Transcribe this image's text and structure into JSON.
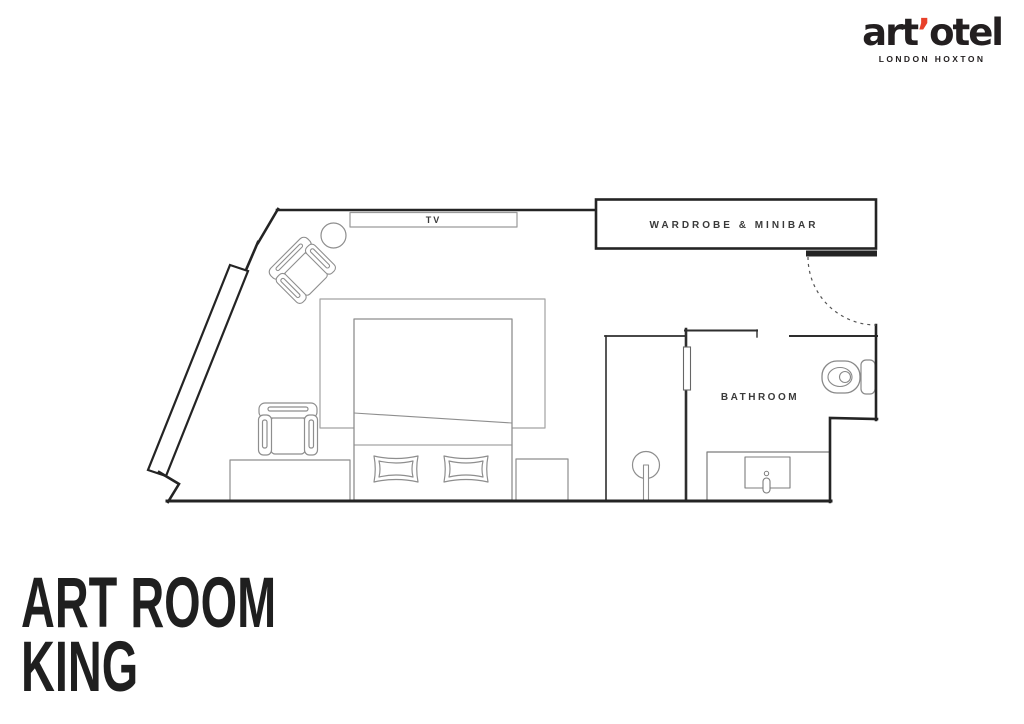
{
  "page": {
    "background": "#ffffff"
  },
  "header": {
    "logo": {
      "brand_pre": "art",
      "apostrophe": "’",
      "brand_post": "otel",
      "tagline": "LONDON HOXTON",
      "accent_color": "#e8402a",
      "text_color": "#231f20"
    }
  },
  "floorplan": {
    "labels": {
      "tv": "TV",
      "wardrobe_minibar": "WARDROBE & MINIBAR",
      "bathroom": "BATHROOM"
    },
    "wall_color": "#242424",
    "furniture_line_color": "#8e8e8e",
    "features": [
      "entry-door",
      "window",
      "tv-unit",
      "wardrobe-minibar",
      "armchair",
      "side-table",
      "desk-chair",
      "bed",
      "pillows",
      "rug",
      "desk",
      "bench",
      "shower",
      "vanity-sink",
      "toilet"
    ]
  },
  "title": {
    "line1": "ART ROOM",
    "line2": "KING"
  }
}
